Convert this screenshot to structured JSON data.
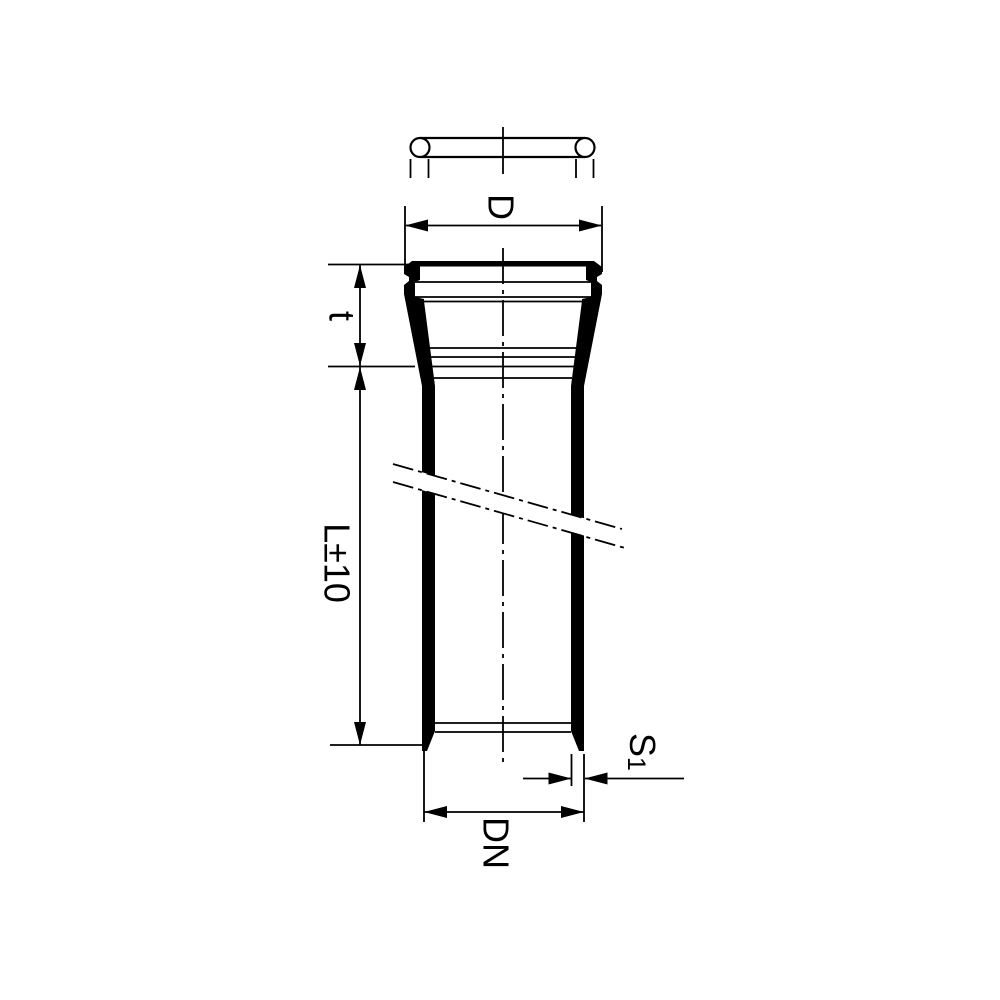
{
  "drawing": {
    "type": "pipe-with-socket-technical-drawing",
    "labels": {
      "socket_outer_diameter": "D",
      "socket_depth": "t",
      "length": "L±10",
      "wall_thickness_main": "S",
      "wall_thickness_sub": "1",
      "nominal_diameter": "DN"
    },
    "colors": {
      "line": "#000000",
      "background": "#ffffff"
    }
  }
}
